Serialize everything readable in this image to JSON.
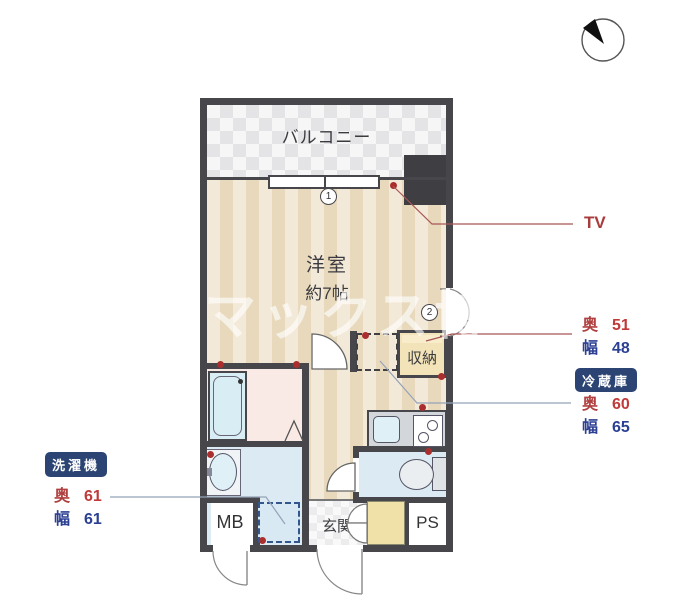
{
  "compass": {
    "north": "N"
  },
  "watermark": "グマックス博",
  "rooms": {
    "balcony": "バルコニー",
    "main_room": "洋室",
    "main_room_size": "約7帖",
    "closet": "収納",
    "entrance": "玄関",
    "meter_box": "MB",
    "pipe_space": "PS"
  },
  "markers": {
    "window1": "1",
    "window2": "2"
  },
  "annotations": {
    "tv": "TV",
    "closet_dims": {
      "depth_label": "奥",
      "depth_value": "51",
      "width_label": "幅",
      "width_value": "48"
    },
    "fridge": {
      "badge": "冷蔵庫",
      "depth_label": "奥",
      "depth_value": "60",
      "width_label": "幅",
      "width_value": "65"
    },
    "washer": {
      "badge": "洗濯機",
      "depth_label": "奥",
      "depth_value": "61",
      "width_label": "幅",
      "width_value": "61"
    }
  },
  "colors": {
    "wall": "#47474b",
    "badge_bg": "#2b4473",
    "dimension_red": "#b04040",
    "dimension_blue": "#2b3f93",
    "leader_red": "#a85555",
    "leader_gray": "#95a3b8",
    "dot_red": "#aa2e2e"
  }
}
